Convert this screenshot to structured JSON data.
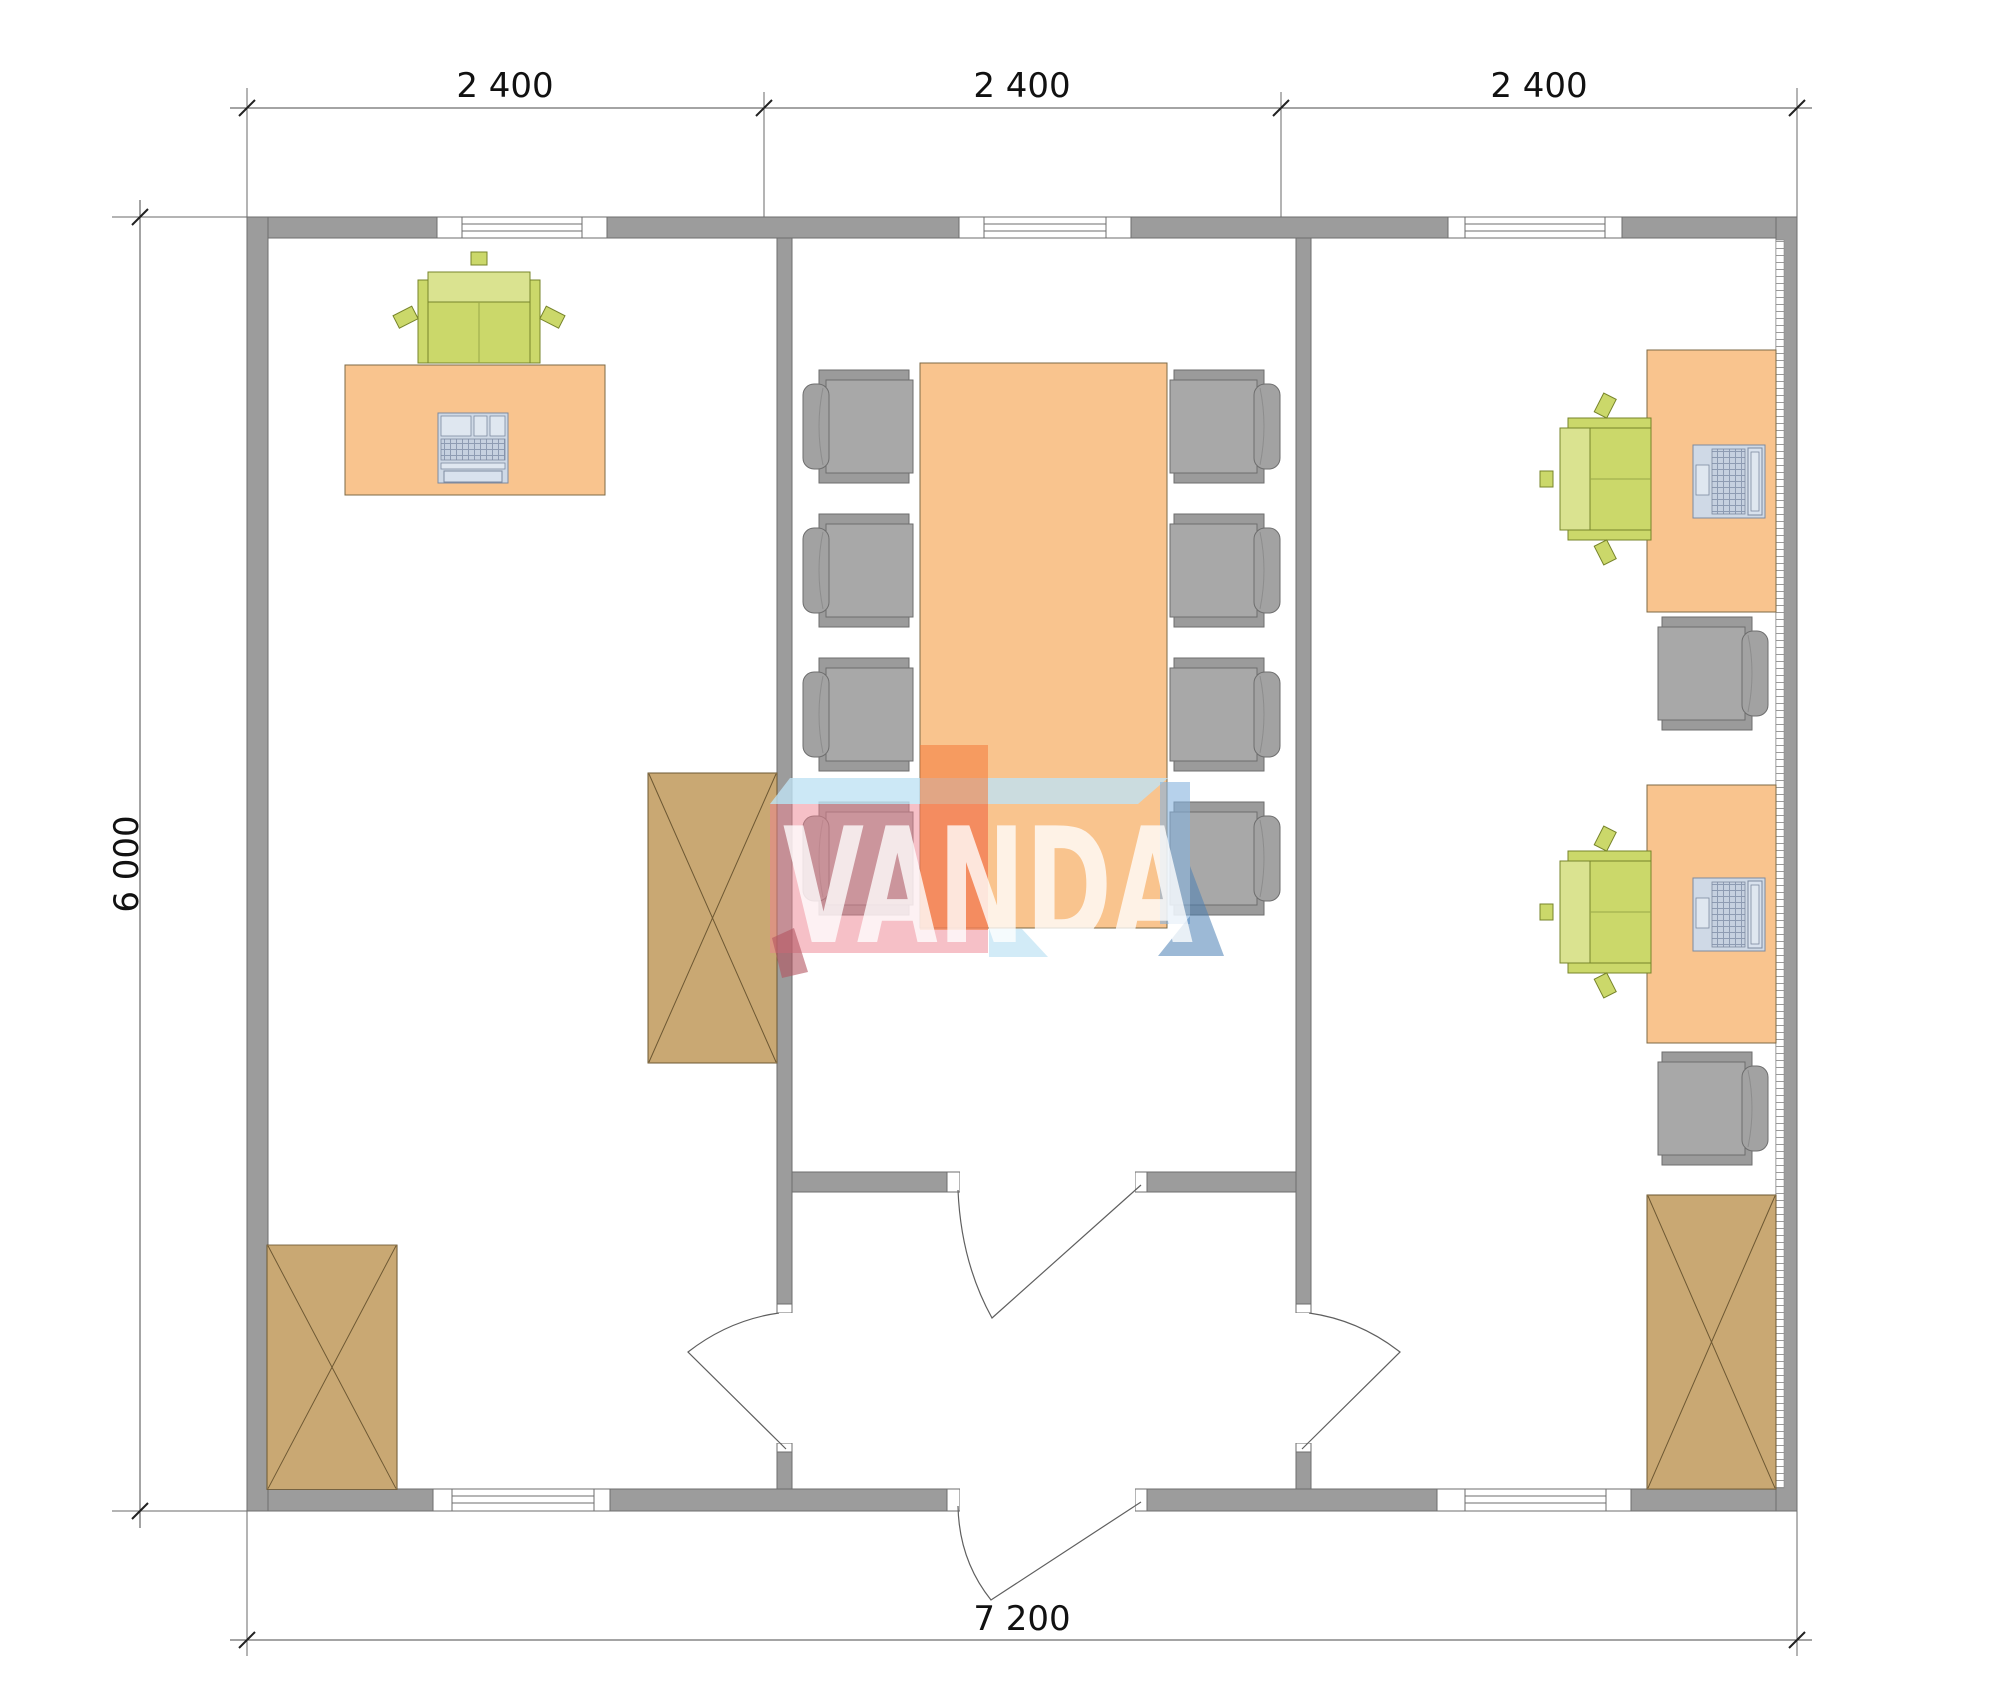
{
  "dimensions": {
    "top": [
      "2 400",
      "2 400",
      "2 400"
    ],
    "left": "6 000",
    "bottom": "7 200"
  },
  "logo": {
    "text": "VANDA"
  },
  "colors": {
    "wall": "#9c9c9c",
    "wall-stroke": "#6e6e6e",
    "desk": "#f9c48e",
    "desk-stroke": "#7d6a45",
    "cabinet": "#c9a873",
    "cabinet-stroke": "#6d5833",
    "chair-green": "#cbd86a",
    "chair-green-light": "#dae390",
    "chair-green-stroke": "#77842b",
    "chair-gray": "#a8a8a8",
    "chair-gray-plate": "#9b9b9b",
    "chair-gray-stroke": "#6e6e6e",
    "computer": "#cfd9e6",
    "computer-stroke": "#7d8aa0",
    "dim-line": "#4a4a4a",
    "dim-text": "#111111",
    "logo-blue": "#bfe2f4",
    "logo-pink": "#ee8290",
    "logo-orange": "#f47a3a",
    "logo-steel": "#85b3dd",
    "logo-dark-blue": "#4a7fb5",
    "logo-dark-red": "#b45560",
    "logo-text": "#ffffff"
  }
}
